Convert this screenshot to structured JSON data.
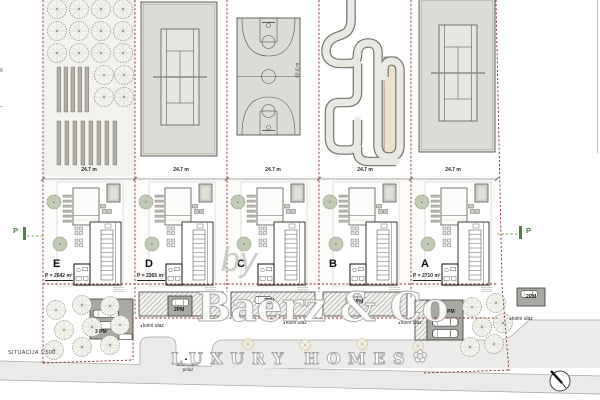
{
  "plan": {
    "scale_label": "SITUACIJA 1:500",
    "plot_width_label": "24.7 m",
    "side_dimension_label": "40.6 m",
    "parking_marker": "P",
    "edge_mark_top": "6",
    "edge_mark_bottom": "–"
  },
  "plots": [
    {
      "letter": "E",
      "area_label": "P = 2642 m²",
      "garage_label": "3 PM"
    },
    {
      "letter": "D",
      "area_label": "P = 2365 m²",
      "parking_label": "2PM"
    },
    {
      "letter": "C",
      "area_label": "",
      "parking_label": "2PM"
    },
    {
      "letter": "B",
      "area_label": "",
      "parking_label": "2PM"
    },
    {
      "letter": "A",
      "area_label": "P = 2710 m²",
      "garage_label": "3 PM",
      "parking_label": "2PM"
    }
  ],
  "roads": {
    "entrance_label": "kolni ulaz",
    "entrance_arrow": "◂",
    "access_label_line1": "kolno-pješ.",
    "access_label_line2": "prilaz",
    "access_arrow": "▲"
  },
  "watermark": {
    "by": "by",
    "brand": "Baerz & Co",
    "tagline": "LUXURY HOMES",
    "ornament": "✿"
  },
  "colors": {
    "boundary_dash": "#8b2f2f",
    "marker_green": "#4e8040",
    "court_fill": "#dcdcd6",
    "garage_fill": "#a9a9a3",
    "road_fill": "#eaeae8",
    "track_infield": "#ece3cf"
  }
}
